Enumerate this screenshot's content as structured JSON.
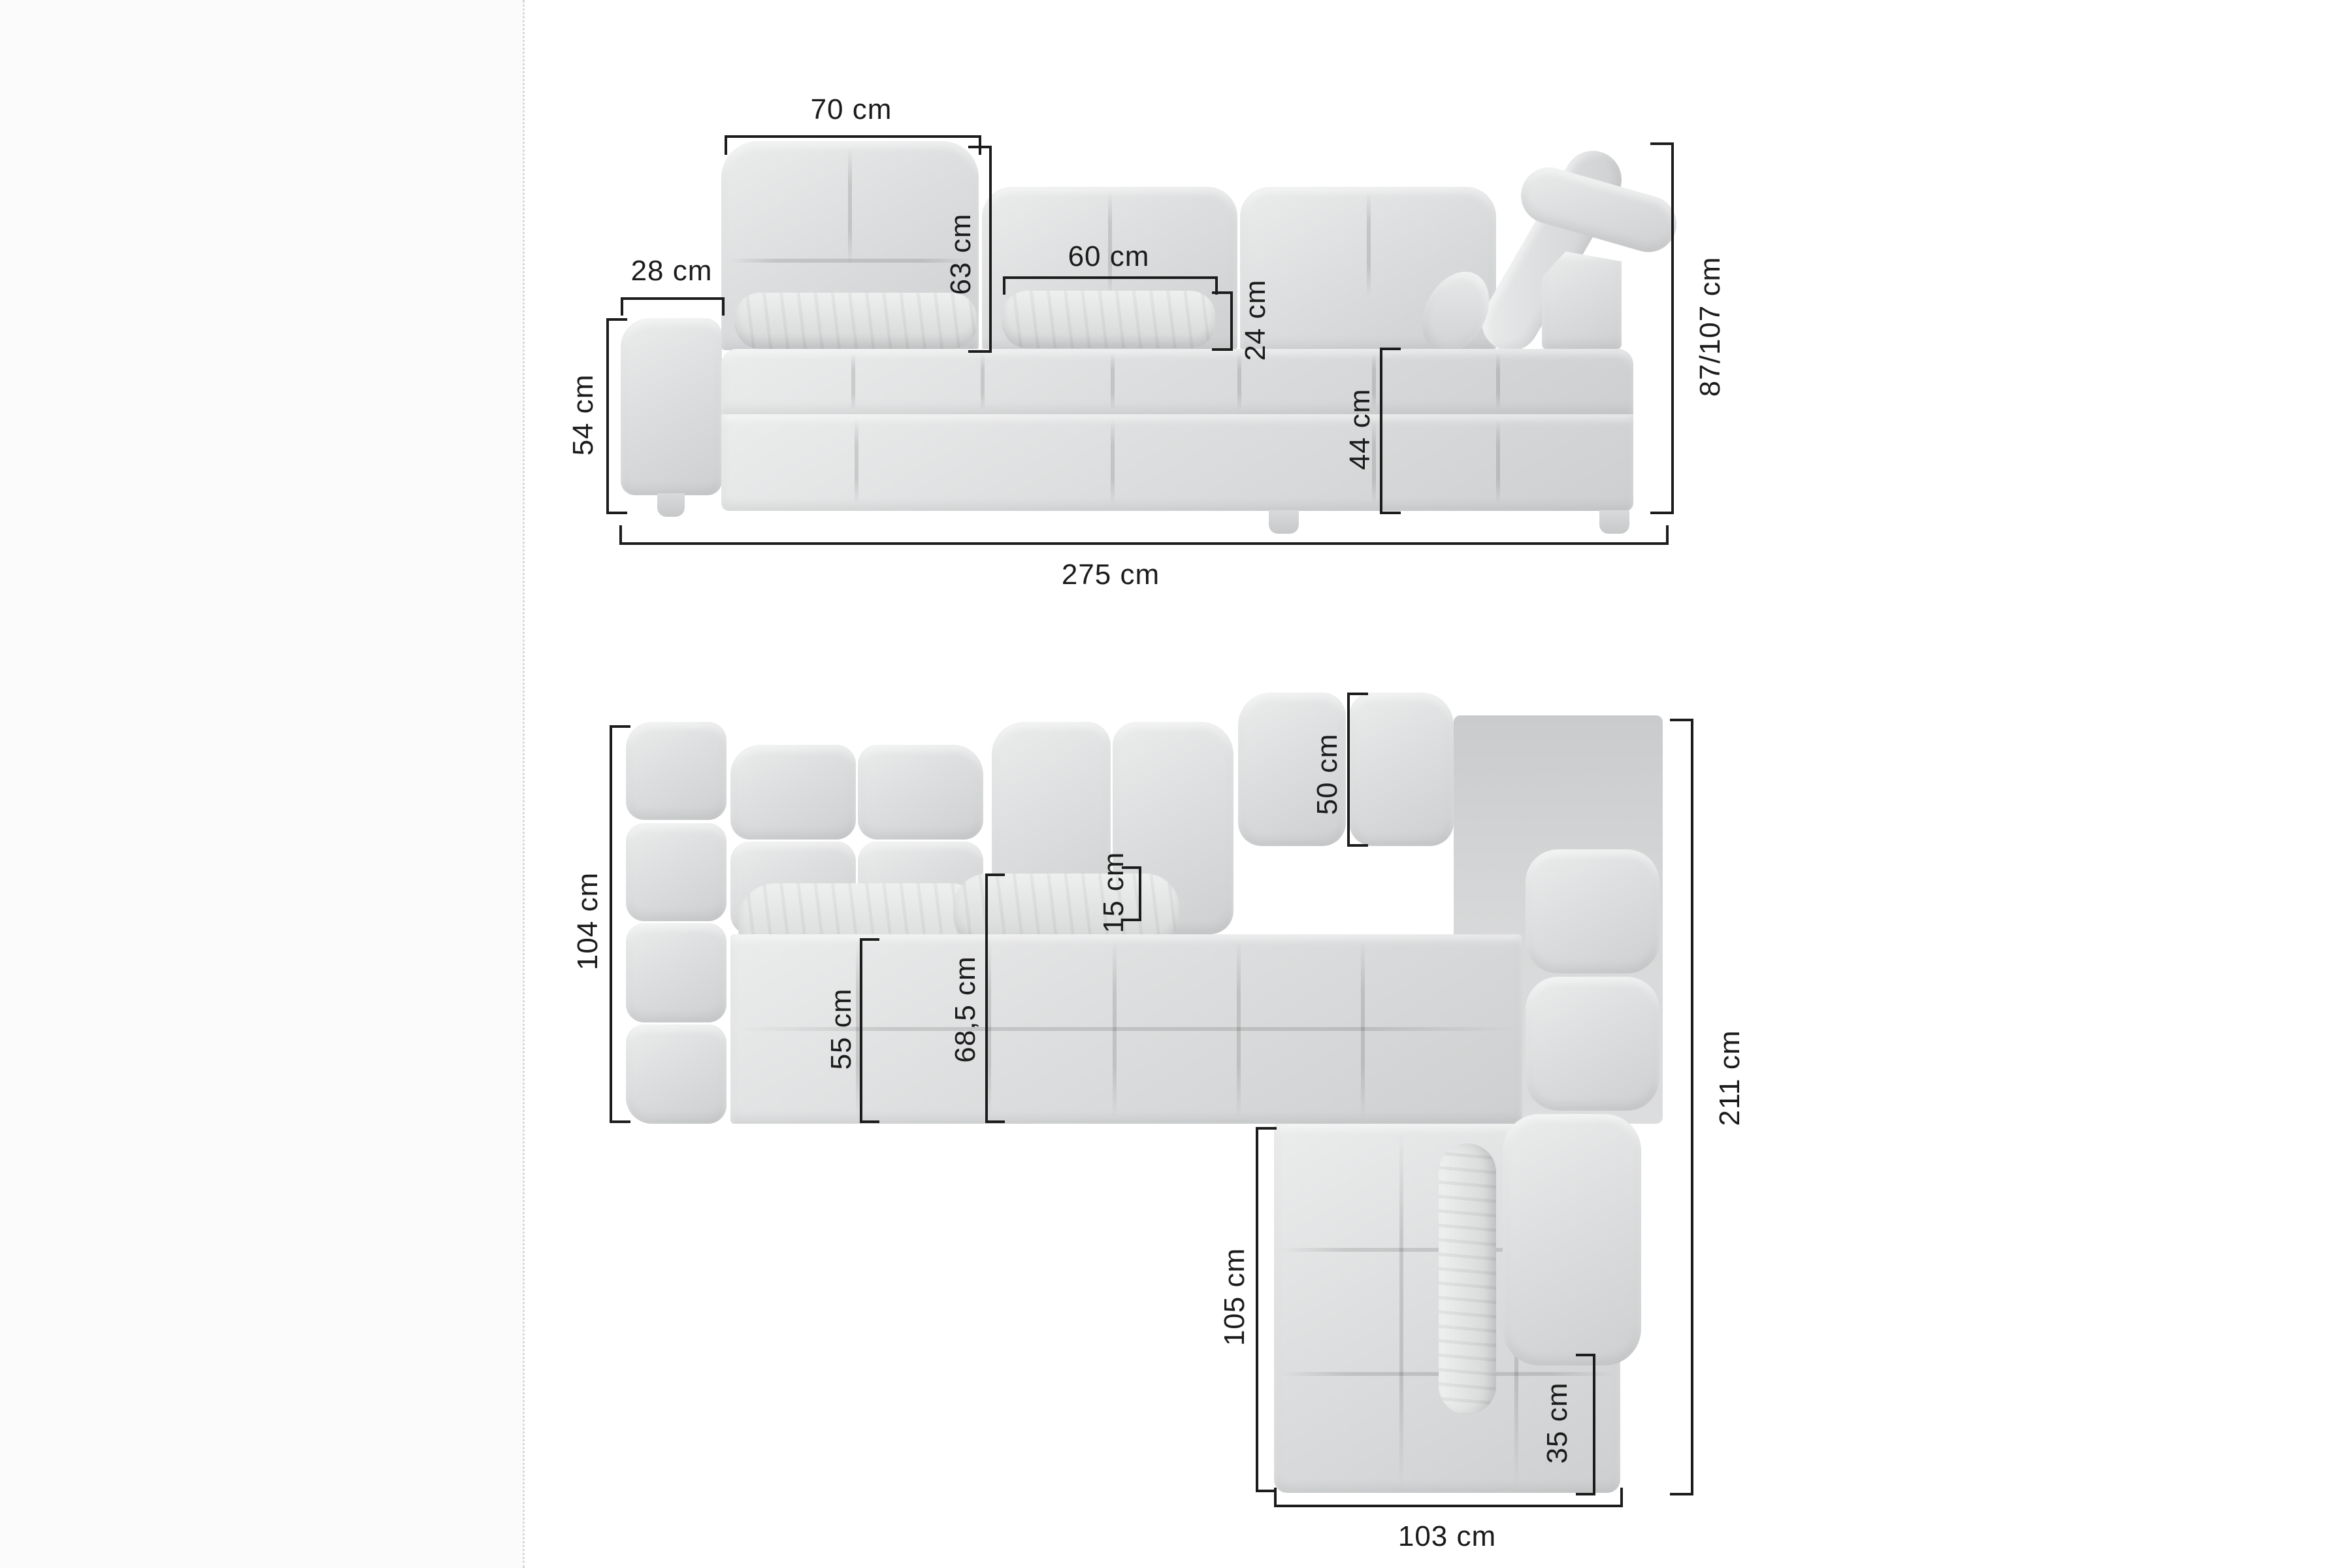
{
  "front_view": {
    "labels": {
      "back_width": "70 cm",
      "armrest_width": "28 cm",
      "back_height": "63 cm",
      "pillow_width": "60 cm",
      "pillow_height": "24 cm",
      "armrest_height": "54 cm",
      "seat_height": "44 cm",
      "total_height": "87/107 cm",
      "total_width": "275 cm"
    }
  },
  "top_view": {
    "labels": {
      "depth": "104 cm",
      "backrest_depth": "50 cm",
      "pillow_depth": "15 cm",
      "seat_width": "55 cm",
      "seat_depth": "68,5 cm",
      "chaise_length": "105 cm",
      "total_length": "211 cm",
      "corner_seat_width": "35 cm",
      "chaise_width": "103 cm"
    }
  },
  "colors": {
    "dimension_line": "#1c1c1c",
    "upholstery_light": "#ebecec",
    "upholstery_mid": "#d8d9da",
    "upholstery_dark": "#c9cbcc",
    "canvas": "#ffffff",
    "page_margin": "#fbfbfb"
  }
}
